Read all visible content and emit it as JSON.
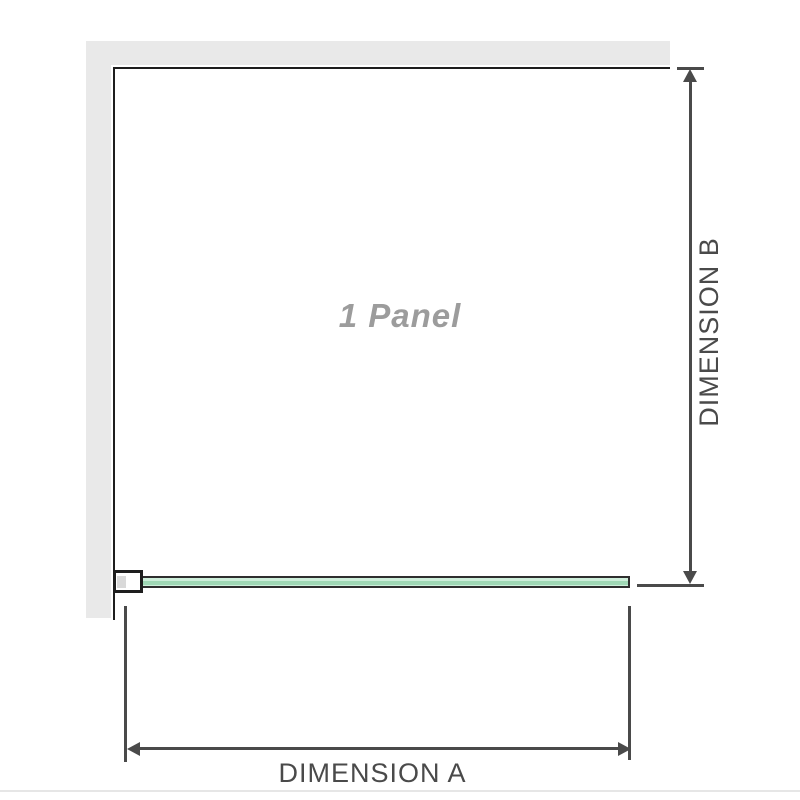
{
  "diagram": {
    "type": "product-dimension-diagram",
    "subject": "1-panel frameless shower screen, plan view with walls",
    "labels": {
      "panel": "1 Panel",
      "dimension_a": "DIMENSION A",
      "dimension_b": "DIMENSION B"
    },
    "parts": {
      "wall": "L-shaped wall (top and left)",
      "glass_panel": "green glass panel along bottom edge",
      "wall_bracket": "wall mounting bracket at left end of glass panel"
    },
    "colors": {
      "background": "#ffffff",
      "wall_fill": "#e9e9e9",
      "wall_edge": "#1e1e1e",
      "dimension_line": "#4a4a4a",
      "dimension_text": "#4a4a4a",
      "glass_fill": "#cdeeda",
      "glass_stripe": "#9fd8b5",
      "glass_border": "#2e2e2e",
      "bracket_insert": "#d9d9d9",
      "panel_label_text": "#9c9c9c",
      "bottom_rule": "#e6e6e6"
    }
  }
}
